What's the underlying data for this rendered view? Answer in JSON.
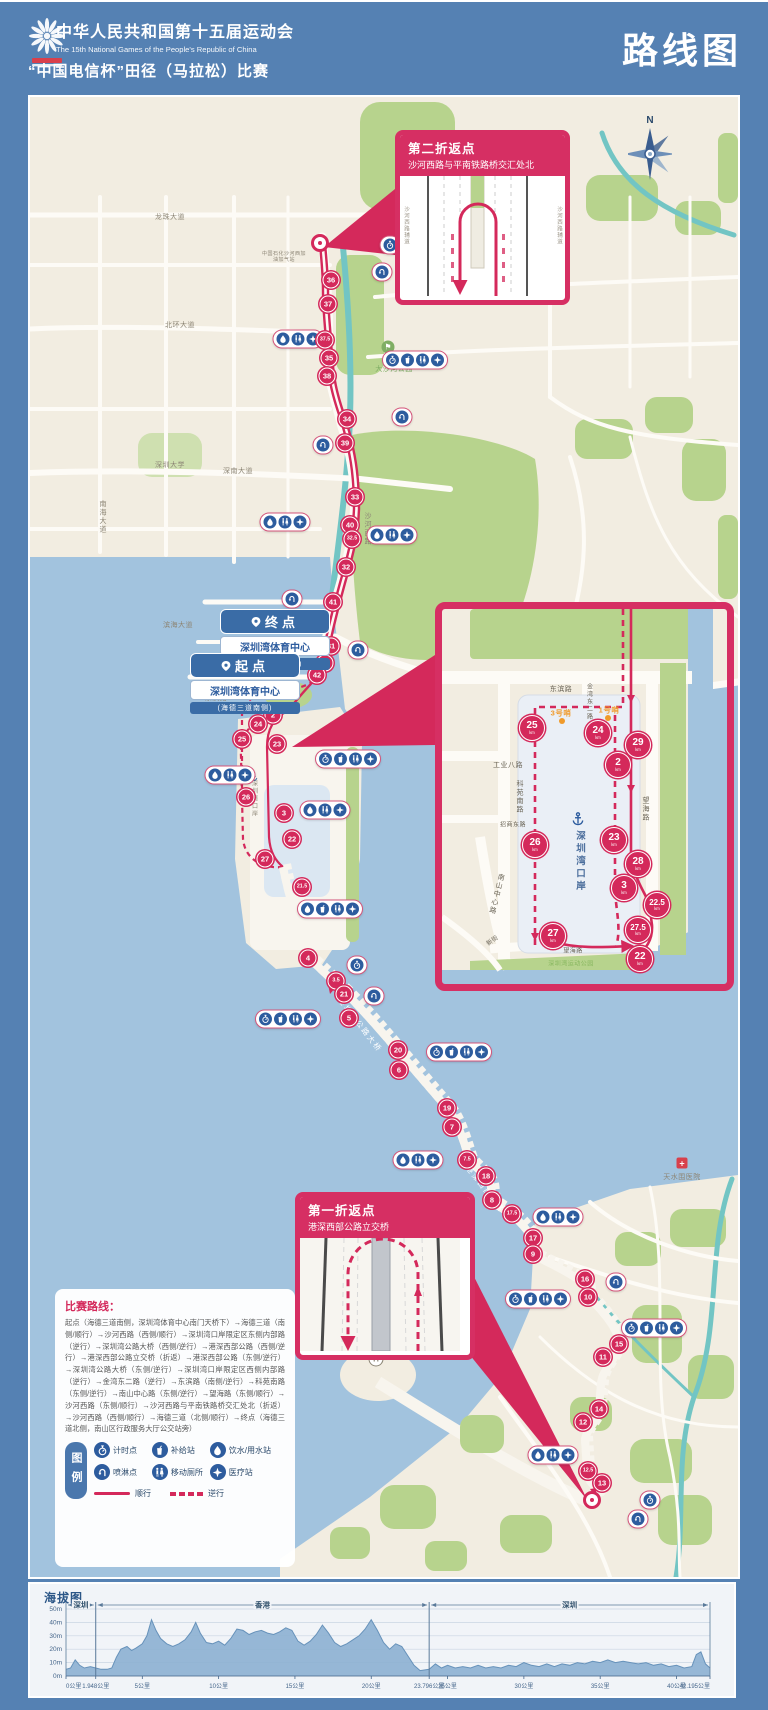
{
  "header": {
    "title_cn": "中华人民共和国第十五届运动会",
    "title_en": "The 15th National Games of the People's Republic of China",
    "subtitle": "“中国电信杯”田径（马拉松）比赛",
    "page_title": "路线图"
  },
  "compass_label": "N",
  "points": {
    "finish": {
      "label": "终点",
      "venue": "深圳湾体育中心",
      "note": "(海德三道北侧)"
    },
    "start": {
      "label": "起点",
      "venue": "深圳湾体育中心",
      "note": "(海德三道南侧)"
    }
  },
  "callout_second": {
    "title": "第二折返点",
    "subtitle": "沙河西路与平南铁路桥交汇处北",
    "side_road": "沙河西路辅道"
  },
  "callout_first": {
    "title": "第一折返点",
    "subtitle": "港深西部公路立交桥"
  },
  "route_description": {
    "title": "比赛路线：",
    "body": "起点（海德三道南侧，深圳湾体育中心南门天桥下）→海德三道（南侧/顺行）→沙河西路（西侧/顺行）→深圳湾口岸限定区东侧内部路（逆行）→深圳湾公路大桥（西侧/逆行）→港深西部公路（西侧/逆行）→港深西部公路立交桥（折返）→港深西部公路（东侧/逆行）→深圳湾公路大桥（东侧/逆行）→深圳湾口岸限定区西侧内部路（逆行）→金湾东二路（逆行）→东滨路（南侧/逆行）→科苑南路（东侧/逆行）→南山中心路（东侧/逆行）→望海路（东侧/顺行）→沙河西路（东侧/顺行）→沙河西路与平南铁路桥交汇处北（折返）→沙河西路（西侧/顺行）→海德三道（北侧/顺行）→终点（海德三道北侧，南山区行政服务大厅公交站旁）"
  },
  "legend": {
    "title": "图例",
    "items": [
      {
        "icon": "timer",
        "label": "计时点"
      },
      {
        "icon": "cup",
        "label": "补给站"
      },
      {
        "icon": "drop",
        "label": "饮水/用水站"
      },
      {
        "icon": "spray",
        "label": "喷淋点"
      },
      {
        "icon": "toilet",
        "label": "移动厕所"
      },
      {
        "icon": "medical",
        "label": "医疗站"
      }
    ],
    "solid_label": "顺行",
    "dashed_label": "逆行"
  },
  "map": {
    "turn_points": [
      {
        "x": 290,
        "y": 146
      },
      {
        "x": 562,
        "y": 1403
      }
    ],
    "km_markers_main": [
      {
        "n": "36",
        "x": 301,
        "y": 183
      },
      {
        "n": "37",
        "x": 298,
        "y": 207
      },
      {
        "n": "37.5",
        "x": 295,
        "y": 243
      },
      {
        "n": "35",
        "x": 299,
        "y": 261
      },
      {
        "n": "38",
        "x": 297,
        "y": 279
      },
      {
        "n": "34",
        "x": 317,
        "y": 322
      },
      {
        "n": "39",
        "x": 315,
        "y": 346
      },
      {
        "n": "33",
        "x": 325,
        "y": 400
      },
      {
        "n": "40",
        "x": 320,
        "y": 428
      },
      {
        "n": "32.5",
        "x": 322,
        "y": 442
      },
      {
        "n": "32",
        "x": 316,
        "y": 470
      },
      {
        "n": "41",
        "x": 303,
        "y": 505
      },
      {
        "n": "31",
        "x": 301,
        "y": 549
      },
      {
        "n": "30",
        "x": 295,
        "y": 566
      },
      {
        "n": "42",
        "x": 287,
        "y": 578
      },
      {
        "n": "2",
        "x": 243,
        "y": 618
      },
      {
        "n": "24",
        "x": 228,
        "y": 627
      },
      {
        "n": "25",
        "x": 212,
        "y": 642
      },
      {
        "n": "23",
        "x": 247,
        "y": 647
      },
      {
        "n": "26",
        "x": 216,
        "y": 700
      },
      {
        "n": "3",
        "x": 254,
        "y": 716
      },
      {
        "n": "22",
        "x": 262,
        "y": 742
      },
      {
        "n": "27",
        "x": 235,
        "y": 762
      },
      {
        "n": "21.5",
        "x": 272,
        "y": 790
      },
      {
        "n": "4",
        "x": 278,
        "y": 861
      },
      {
        "n": "3.5",
        "x": 306,
        "y": 884
      },
      {
        "n": "21",
        "x": 314,
        "y": 897
      },
      {
        "n": "5",
        "x": 319,
        "y": 921
      },
      {
        "n": "20",
        "x": 368,
        "y": 953
      },
      {
        "n": "6",
        "x": 369,
        "y": 973
      },
      {
        "n": "19",
        "x": 417,
        "y": 1011
      },
      {
        "n": "7",
        "x": 422,
        "y": 1030
      },
      {
        "n": "7.5",
        "x": 437,
        "y": 1063
      },
      {
        "n": "18",
        "x": 456,
        "y": 1079
      },
      {
        "n": "8",
        "x": 462,
        "y": 1103
      },
      {
        "n": "17.5",
        "x": 482,
        "y": 1117
      },
      {
        "n": "17",
        "x": 503,
        "y": 1141
      },
      {
        "n": "9",
        "x": 503,
        "y": 1157
      },
      {
        "n": "16",
        "x": 555,
        "y": 1182
      },
      {
        "n": "10",
        "x": 558,
        "y": 1200
      },
      {
        "n": "15",
        "x": 589,
        "y": 1247
      },
      {
        "n": "11",
        "x": 573,
        "y": 1260
      },
      {
        "n": "14",
        "x": 569,
        "y": 1312
      },
      {
        "n": "12",
        "x": 553,
        "y": 1325
      },
      {
        "n": "12.5",
        "x": 558,
        "y": 1374
      },
      {
        "n": "13",
        "x": 572,
        "y": 1386
      }
    ],
    "km_markers_inset": [
      {
        "n": "25",
        "x": 502,
        "y": 631
      },
      {
        "n": "24",
        "x": 568,
        "y": 636
      },
      {
        "n": "29",
        "x": 608,
        "y": 648
      },
      {
        "n": "2",
        "x": 588,
        "y": 668
      },
      {
        "n": "26",
        "x": 505,
        "y": 748
      },
      {
        "n": "23",
        "x": 584,
        "y": 743
      },
      {
        "n": "28",
        "x": 608,
        "y": 767
      },
      {
        "n": "3",
        "x": 594,
        "y": 791
      },
      {
        "n": "22.5",
        "x": 627,
        "y": 808
      },
      {
        "n": "27",
        "x": 523,
        "y": 839
      },
      {
        "n": "27.5",
        "x": 608,
        "y": 833
      },
      {
        "n": "22",
        "x": 610,
        "y": 862
      }
    ],
    "km_unit": "km",
    "facility_pills": [
      {
        "x": 360,
        "y": 148,
        "icons": [
          "timer"
        ]
      },
      {
        "x": 352,
        "y": 175,
        "icons": [
          "spray"
        ]
      },
      {
        "x": 268,
        "y": 242,
        "icons": [
          "drop",
          "toilet",
          "medical"
        ]
      },
      {
        "x": 385,
        "y": 263,
        "icons": [
          "timer",
          "cup",
          "toilet",
          "medical"
        ]
      },
      {
        "x": 372,
        "y": 320,
        "icons": [
          "spray"
        ]
      },
      {
        "x": 293,
        "y": 348,
        "icons": [
          "spray"
        ]
      },
      {
        "x": 255,
        "y": 425,
        "icons": [
          "drop",
          "toilet",
          "medical"
        ]
      },
      {
        "x": 362,
        "y": 438,
        "icons": [
          "drop",
          "toilet",
          "medical"
        ]
      },
      {
        "x": 262,
        "y": 502,
        "icons": [
          "spray"
        ]
      },
      {
        "x": 328,
        "y": 553,
        "icons": [
          "spray"
        ]
      },
      {
        "x": 318,
        "y": 662,
        "icons": [
          "timer",
          "cup",
          "toilet",
          "medical"
        ]
      },
      {
        "x": 200,
        "y": 678,
        "icons": [
          "drop",
          "toilet",
          "medical"
        ]
      },
      {
        "x": 295,
        "y": 713,
        "icons": [
          "drop",
          "toilet",
          "medical"
        ]
      },
      {
        "x": 300,
        "y": 812,
        "icons": [
          "drop",
          "cup",
          "toilet",
          "medical"
        ]
      },
      {
        "x": 327,
        "y": 868,
        "icons": [
          "timer"
        ]
      },
      {
        "x": 344,
        "y": 899,
        "icons": [
          "spray"
        ]
      },
      {
        "x": 258,
        "y": 922,
        "icons": [
          "timer",
          "cup",
          "toilet",
          "medical"
        ]
      },
      {
        "x": 429,
        "y": 955,
        "icons": [
          "timer",
          "cup",
          "toilet",
          "medical"
        ]
      },
      {
        "x": 388,
        "y": 1063,
        "icons": [
          "drop",
          "toilet",
          "medical"
        ]
      },
      {
        "x": 528,
        "y": 1120,
        "icons": [
          "drop",
          "toilet",
          "medical"
        ]
      },
      {
        "x": 586,
        "y": 1185,
        "icons": [
          "spray"
        ]
      },
      {
        "x": 508,
        "y": 1202,
        "icons": [
          "timer",
          "cup",
          "toilet",
          "medical"
        ]
      },
      {
        "x": 624,
        "y": 1231,
        "icons": [
          "timer",
          "cup",
          "toilet",
          "medical"
        ]
      },
      {
        "x": 523,
        "y": 1358,
        "icons": [
          "drop",
          "toilet",
          "medical"
        ]
      },
      {
        "x": 620,
        "y": 1403,
        "icons": [
          "timer"
        ]
      },
      {
        "x": 608,
        "y": 1422,
        "icons": [
          "spray"
        ]
      }
    ],
    "labels": [
      {
        "t": "龙珠大道",
        "x": 140,
        "y": 120,
        "c": "gray"
      },
      {
        "t": "北环大道",
        "x": 150,
        "y": 228,
        "c": "gray"
      },
      {
        "t": "中国石化沙河西加油加气站",
        "x": 254,
        "y": 160,
        "c": "gray",
        "tiny": 1
      },
      {
        "t": "大沙河公园",
        "x": 364,
        "y": 272,
        "c": "green"
      },
      {
        "t": "深圳大学",
        "x": 140,
        "y": 368,
        "c": "gray"
      },
      {
        "t": "深南大道",
        "x": 208,
        "y": 374,
        "c": "gray"
      },
      {
        "t": "南海大道",
        "x": 72,
        "y": 420,
        "c": "gray",
        "v": 1
      },
      {
        "t": "沙河西路",
        "x": 337,
        "y": 432,
        "c": "gray",
        "v": 1
      },
      {
        "t": "滨海大道",
        "x": 148,
        "y": 528,
        "c": "gray"
      },
      {
        "t": "深圳人才公园",
        "x": 206,
        "y": 566,
        "c": "green"
      },
      {
        "t": "东滨路",
        "x": 186,
        "y": 601,
        "c": "gray"
      },
      {
        "t": "深圳湾口岸",
        "x": 224,
        "y": 702,
        "c": "gray",
        "v": 1,
        "sm": 1
      },
      {
        "t": "深圳湾公路大桥",
        "x": 330,
        "y": 928,
        "c": "white",
        "r": 52
      },
      {
        "t": "港深西部公路",
        "x": 455,
        "y": 1092,
        "c": "white",
        "r": 52
      },
      {
        "t": "天水围医院",
        "x": 652,
        "y": 1080,
        "c": "gray"
      }
    ],
    "inset_labels": [
      {
        "t": "东滨路",
        "x": 531,
        "y": 592,
        "c": "dark"
      },
      {
        "t": "金湾东二路",
        "x": 559,
        "y": 605,
        "c": "dark",
        "v": 1,
        "sm": 1
      },
      {
        "t": "3号哨",
        "x": 531,
        "y": 616,
        "c": "orange"
      },
      {
        "t": "1号哨",
        "x": 579,
        "y": 613,
        "c": "orange"
      },
      {
        "t": "工业八路",
        "x": 478,
        "y": 668,
        "c": "dark"
      },
      {
        "t": "科苑南路",
        "x": 489,
        "y": 700,
        "c": "dark",
        "v": 1
      },
      {
        "t": "招商东路",
        "x": 483,
        "y": 727,
        "c": "dark",
        "sm": 1
      },
      {
        "t": "南山中心路",
        "x": 466,
        "y": 797,
        "c": "dark",
        "v": 1,
        "r": 14
      },
      {
        "t": "望海路",
        "x": 615,
        "y": 712,
        "c": "dark",
        "v": 1
      },
      {
        "t": "深圳湾口岸",
        "x": 549,
        "y": 765,
        "c": "blue",
        "v": 1
      },
      {
        "t": "新街",
        "x": 462,
        "y": 843,
        "c": "dark",
        "sm": 1,
        "r": -35
      },
      {
        "t": "望海路",
        "x": 543,
        "y": 853,
        "c": "dark",
        "sm": 1
      },
      {
        "t": "深圳湾运动公园",
        "x": 541,
        "y": 866,
        "c": "parkgreen",
        "sm": 1
      }
    ],
    "pois": [
      {
        "type": "golf",
        "x": 358,
        "y": 250
      },
      {
        "type": "hospital",
        "x": 652,
        "y": 1066
      },
      {
        "type": "toll",
        "x": 346,
        "y": 1262
      },
      {
        "type": "anchor",
        "x": 224,
        "y": 676,
        "s": 9
      },
      {
        "type": "anchor",
        "x": 548,
        "y": 722,
        "s": 15
      }
    ]
  },
  "chart_data": {
    "type": "area",
    "title": "海拔图",
    "xlabel": "距离",
    "ylabel": "海拔",
    "xlim": [
      0,
      42.195
    ],
    "ylim": [
      0,
      50
    ],
    "grid": true,
    "y_ticks": [
      {
        "v": 0,
        "label": "0m"
      },
      {
        "v": 10,
        "label": "10m"
      },
      {
        "v": 20,
        "label": "20m"
      },
      {
        "v": 30,
        "label": "30m"
      },
      {
        "v": 40,
        "label": "40m"
      },
      {
        "v": 50,
        "label": "50m"
      }
    ],
    "x_ticks": [
      {
        "v": 0,
        "label": "0公里"
      },
      {
        "v": 1.948,
        "label": "1.948公里"
      },
      {
        "v": 5,
        "label": "5公里"
      },
      {
        "v": 10,
        "label": "10公里"
      },
      {
        "v": 15,
        "label": "15公里"
      },
      {
        "v": 20,
        "label": "20公里"
      },
      {
        "v": 23.796,
        "label": "23.796公里"
      },
      {
        "v": 25,
        "label": "25公里"
      },
      {
        "v": 30,
        "label": "30公里"
      },
      {
        "v": 35,
        "label": "35公里"
      },
      {
        "v": 40,
        "label": "40公里"
      },
      {
        "v": 42.195,
        "label": "42.195公里"
      }
    ],
    "sections": [
      {
        "label": "深圳",
        "from": 0,
        "to": 1.948
      },
      {
        "label": "香港",
        "from": 1.948,
        "to": 23.796
      },
      {
        "label": "深圳",
        "from": 23.796,
        "to": 42.195
      }
    ],
    "points": [
      [
        0,
        5
      ],
      [
        0.3,
        6
      ],
      [
        0.6,
        12
      ],
      [
        0.9,
        8
      ],
      [
        1.2,
        6
      ],
      [
        1.6,
        7
      ],
      [
        1.948,
        6
      ],
      [
        2.3,
        5
      ],
      [
        2.7,
        5
      ],
      [
        3,
        6
      ],
      [
        3.3,
        14
      ],
      [
        3.6,
        20
      ],
      [
        4,
        22
      ],
      [
        4.3,
        19
      ],
      [
        4.6,
        21
      ],
      [
        5,
        24
      ],
      [
        5.3,
        30
      ],
      [
        5.6,
        42
      ],
      [
        5.9,
        34
      ],
      [
        6.2,
        28
      ],
      [
        6.6,
        24
      ],
      [
        7,
        22
      ],
      [
        7.4,
        24
      ],
      [
        7.8,
        27
      ],
      [
        8.2,
        33
      ],
      [
        8.5,
        40
      ],
      [
        8.8,
        32
      ],
      [
        9.2,
        25
      ],
      [
        9.6,
        24
      ],
      [
        10,
        26
      ],
      [
        10.4,
        23
      ],
      [
        10.8,
        28
      ],
      [
        11.2,
        35
      ],
      [
        11.6,
        34
      ],
      [
        12,
        31
      ],
      [
        12.4,
        33
      ],
      [
        12.8,
        34
      ],
      [
        13.2,
        32
      ],
      [
        13.6,
        31
      ],
      [
        14,
        33
      ],
      [
        14.4,
        36
      ],
      [
        14.8,
        34
      ],
      [
        15.2,
        26
      ],
      [
        15.6,
        23
      ],
      [
        16,
        26
      ],
      [
        16.4,
        31
      ],
      [
        16.8,
        38
      ],
      [
        17.2,
        32
      ],
      [
        17.6,
        25
      ],
      [
        18,
        22
      ],
      [
        18.4,
        24
      ],
      [
        18.8,
        27
      ],
      [
        19.2,
        30
      ],
      [
        19.6,
        35
      ],
      [
        20,
        42
      ],
      [
        20.4,
        34
      ],
      [
        20.8,
        25
      ],
      [
        21.2,
        20
      ],
      [
        21.6,
        24
      ],
      [
        22,
        22
      ],
      [
        22.4,
        15
      ],
      [
        22.8,
        8
      ],
      [
        23.2,
        4
      ],
      [
        23.796,
        5
      ],
      [
        24.2,
        9
      ],
      [
        24.6,
        6
      ],
      [
        25,
        8
      ],
      [
        25.5,
        6
      ],
      [
        26,
        7
      ],
      [
        26.5,
        6
      ],
      [
        27,
        8
      ],
      [
        27.5,
        6
      ],
      [
        28,
        7
      ],
      [
        28.5,
        6
      ],
      [
        29,
        8
      ],
      [
        29.5,
        7
      ],
      [
        30,
        10
      ],
      [
        30.5,
        8
      ],
      [
        31,
        7
      ],
      [
        31.5,
        9
      ],
      [
        32,
        7
      ],
      [
        32.5,
        9
      ],
      [
        33,
        8
      ],
      [
        33.5,
        10
      ],
      [
        34,
        9
      ],
      [
        34.5,
        11
      ],
      [
        35,
        10
      ],
      [
        35.5,
        12
      ],
      [
        36,
        10
      ],
      [
        36.5,
        11
      ],
      [
        37,
        10
      ],
      [
        37.5,
        9
      ],
      [
        38,
        10
      ],
      [
        38.5,
        8
      ],
      [
        39,
        9
      ],
      [
        39.5,
        7
      ],
      [
        40,
        8
      ],
      [
        40.5,
        6
      ],
      [
        41,
        7
      ],
      [
        41.3,
        16
      ],
      [
        41.6,
        18
      ],
      [
        41.9,
        9
      ],
      [
        42.195,
        6
      ]
    ]
  },
  "colors": {
    "accent": "#d4295b",
    "callout": "#d62f63",
    "blue": "#2d5c9e",
    "water": "#a2c3de",
    "green": "#b7d38d",
    "cream": "#f2ede1",
    "orange": "#f09a2a",
    "frame_blue": "#5581b3"
  }
}
